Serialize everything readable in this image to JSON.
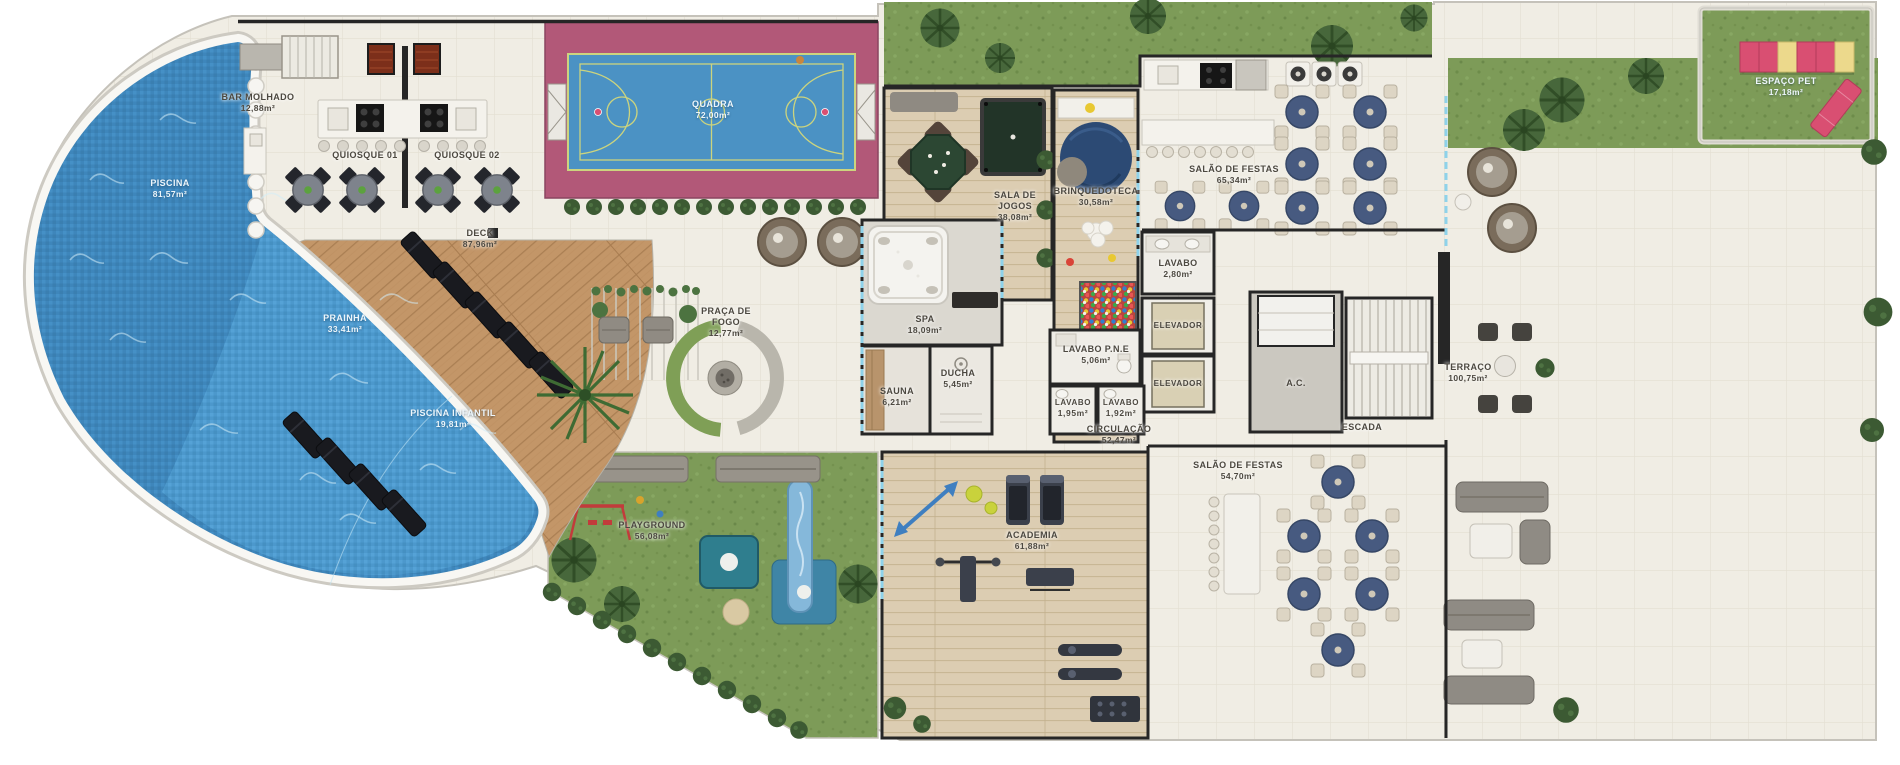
{
  "rooms": {
    "piscina": {
      "name": "PISCINA",
      "area": "81,57m²"
    },
    "bar_molhado": {
      "name": "BAR MOLHADO",
      "area": "12,88m²"
    },
    "quiosque_01": {
      "name": "QUIOSQUE 01"
    },
    "quiosque_02": {
      "name": "QUIOSQUE 02"
    },
    "quadra": {
      "name": "QUADRA",
      "area": "72,00m²"
    },
    "deck": {
      "name": "DECK",
      "area": "87,96m²"
    },
    "prainha": {
      "name": "PRAINHA",
      "area": "33,41m²"
    },
    "piscina_infantil": {
      "name": "PISCINA INFANTIL",
      "area": "19,81m²"
    },
    "praca_de_fogo": {
      "name": "PRAÇA DE FOGO",
      "area": "12,77m²"
    },
    "sala_de_jogos": {
      "name": "SALA DE JOGOS",
      "area": "38,08m²"
    },
    "brinquedoteca": {
      "name": "BRINQUEDOTECA",
      "area": "30,58m²"
    },
    "salao_de_festas_superior": {
      "name": "SALÃO DE FESTAS",
      "area": "65,34m²"
    },
    "espaco_pet": {
      "name": "ESPAÇO PET",
      "area": "17,18m²"
    },
    "spa": {
      "name": "SPA",
      "area": "18,09m²"
    },
    "sauna": {
      "name": "SAUNA",
      "area": "6,21m²"
    },
    "ducha": {
      "name": "DUCHA",
      "area": "5,45m²"
    },
    "lavabo": {
      "name": "LAVABO",
      "area": "2,80m²"
    },
    "lavabo_pne": {
      "name": "LAVABO P.N.E",
      "area": "5,06m²"
    },
    "lavabo_2": {
      "name": "LAVABO",
      "area": "1,95m²"
    },
    "lavabo_3": {
      "name": "LAVABO",
      "area": "1,92m²"
    },
    "elevador_1": {
      "name": "ELEVADOR"
    },
    "elevador_2": {
      "name": "ELEVADOR"
    },
    "circulacao": {
      "name": "CIRCULAÇÃO",
      "area": "52,47m²"
    },
    "ac": {
      "name": "A.C."
    },
    "escada": {
      "name": "ESCADA"
    },
    "terraco": {
      "name": "TERRAÇO",
      "area": "100,75m²"
    },
    "salao_de_festas_inferior": {
      "name": "SALÃO DE FESTAS",
      "area": "54,70m²"
    },
    "academia": {
      "name": "ACADEMIA",
      "area": "61,88m²"
    },
    "playground": {
      "name": "PLAYGROUND",
      "area": "56,08m²"
    }
  },
  "colors": {
    "water": "#3e86bb",
    "water_light": "#4e9bce",
    "deck_wood": "#c39668",
    "indoor_wood": "#dccdb2",
    "floor_tile": "#f0ede4",
    "grass": "#7d9b58",
    "court_surround": "#b25878",
    "court_floor": "#4b92c4",
    "court_lines": "#ccd47e",
    "party_table": "#475a80",
    "pet_pink": "#d94f72",
    "pet_yellow": "#ecd98c",
    "wall": "#262626",
    "glass": "#8ed2ea"
  }
}
